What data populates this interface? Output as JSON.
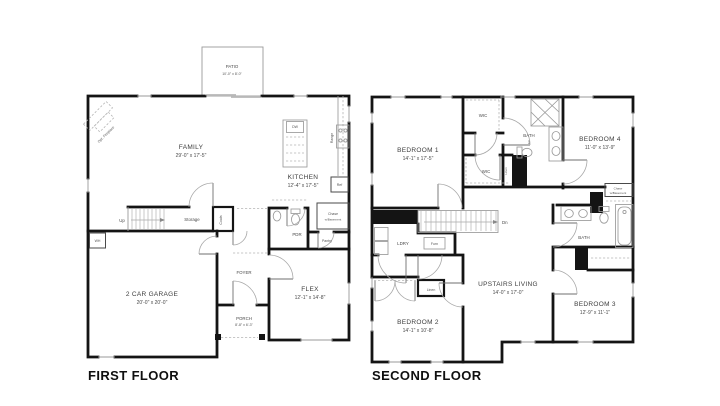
{
  "ff": {
    "title": "FIRST FLOOR",
    "patio": {
      "name": "PATIO",
      "dims": "10'-0\" x 8'-0\""
    },
    "family": {
      "name": "FAMILY",
      "dims": "29'-0\" x 17'-5\""
    },
    "kitchen": {
      "name": "KITCHEN",
      "dims": "12'-4\" x 17'-5\""
    },
    "garage": {
      "name": "2 CAR GARAGE",
      "dims": "20'-0\" x 20'-0\""
    },
    "flex": {
      "name": "FLEX",
      "dims": "12'-1\" x 14'-8\""
    },
    "porch": {
      "name": "PORCH",
      "dims": "8'-8\" x 6'-3\""
    },
    "foyer": "FOYER",
    "pdr": "PDR",
    "pantry": "Pantry",
    "storage": "Storage",
    "coats": "Coats",
    "up": "Up",
    "wh": "WH",
    "dw": "DW",
    "range": "Range",
    "ref": "Ref",
    "chase": {
      "l1": "Chase",
      "l2": "w/Basement"
    },
    "fireplace": "Opt. Fireplace"
  },
  "sf": {
    "title": "SECOND FLOOR",
    "bedroom1": {
      "name": "BEDROOM 1",
      "dims": "14'-1\" x 17'-5\""
    },
    "bedroom2": {
      "name": "BEDROOM 2",
      "dims": "14'-1\" x 10'-8\""
    },
    "bedroom3": {
      "name": "BEDROOM 3",
      "dims": "12'-9\" x 11'-1\""
    },
    "bedroom4": {
      "name": "BEDROOM 4",
      "dims": "11'-0\" x 13'-9\""
    },
    "living": {
      "name": "UPSTAIRS LIVING",
      "dims": "14'-0\" x 17'-0\""
    },
    "bath1": {
      "l1": "BATH",
      "l2": "1"
    },
    "bath": "BATH",
    "wic1": "WIC",
    "wic2": "WIC",
    "linen_side": "Linen",
    "linen": "Linen",
    "ldry": "LDRY",
    "furn": "Furn",
    "dn": "Dn",
    "chase": {
      "l1": "Chase",
      "l2": "w/Basement"
    }
  }
}
